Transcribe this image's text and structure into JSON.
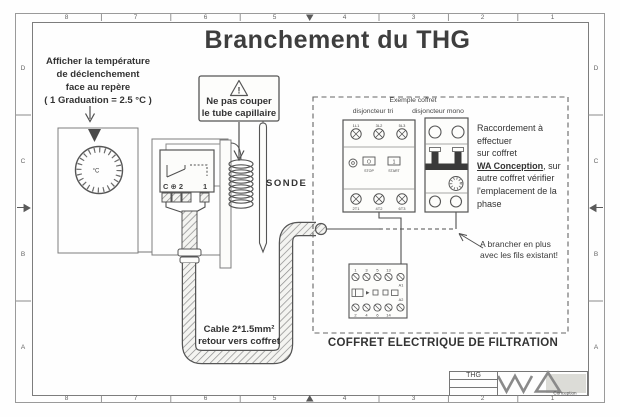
{
  "frame": {
    "cols": [
      "8",
      "7",
      "6",
      "5",
      "4",
      "3",
      "2",
      "1"
    ],
    "rows": [
      "D",
      "C",
      "B",
      "A"
    ]
  },
  "title": "Branchement du THG",
  "display_note": {
    "line1": "Afficher la température",
    "line2": "de déclenchement",
    "line3": "face au repère",
    "line4": "( 1 Graduation = 2.5 °C )"
  },
  "warning": {
    "symbol": "!",
    "line1": "Ne pas couper",
    "line2": "le tube capillaire"
  },
  "thermostat": {
    "terminals_left": "C ⊕ 2",
    "terminal_right": "1",
    "dial_unit": "°C"
  },
  "sonde_label": "SONDE",
  "cable_note": {
    "line1": "Cable 2*1.5mm²",
    "line2": "retour vers coffret"
  },
  "panel": {
    "header": "Exemple coffret",
    "breaker_tri": "disjoncteur tri",
    "breaker_mono": "disjoncteur mono",
    "tri_top": [
      "1L1",
      "3L2",
      "5L3"
    ],
    "tri_bottom": [
      "2T1",
      "4T2",
      "6T3"
    ],
    "stop_btn": "O",
    "stop_label": "STOP",
    "start_btn": "1",
    "start_label": "START",
    "contactor_top": [
      "1",
      "3",
      "5",
      "13"
    ],
    "contactor_bottom": [
      "2",
      "4",
      "6",
      "14"
    ],
    "coil_a1": "A1",
    "coil_a2": "A2"
  },
  "raccord_note": {
    "line1": "Raccordement à",
    "line2": "effectuer",
    "line3": "sur coffret",
    "line4_bold": "WA Conception",
    "line4_rest": ", sur",
    "line5": "autre coffret vérifier",
    "line6": "l'emplacement de la",
    "line7": "phase"
  },
  "brancher_note": {
    "line1": "A brancher en plus",
    "line2": "avec les fils existant!"
  },
  "coffret_label": "COFFRET ELECTRIQUE DE FILTRATION",
  "titleblock": {
    "code": "THG",
    "logo_text": "Conception"
  },
  "colors": {
    "line": "#555555",
    "text": "#3a3a3a",
    "hatch_bg": "#f4f4f1"
  }
}
